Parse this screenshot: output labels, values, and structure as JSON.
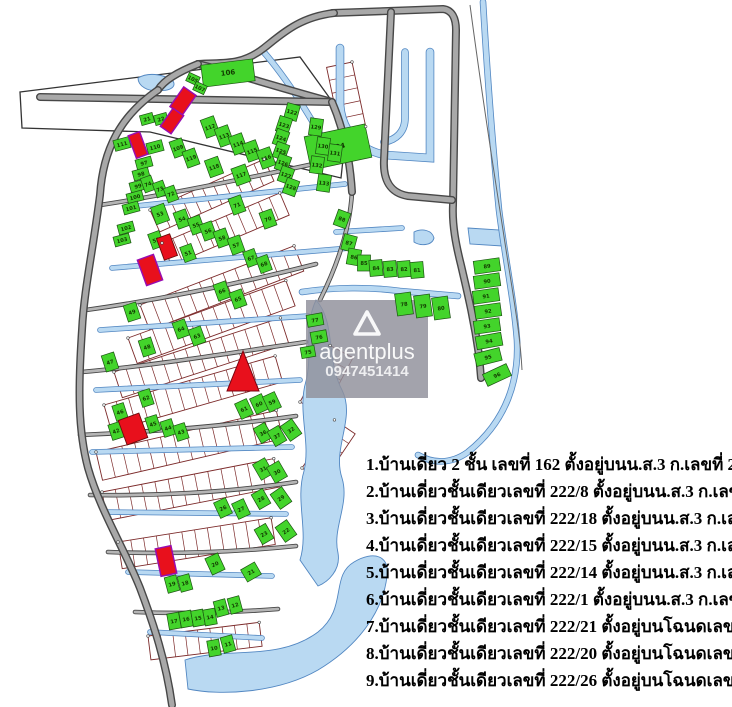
{
  "watermark": {
    "brand": "agentplus",
    "phone": "0947451414",
    "logo": "triangle-logo"
  },
  "listings": {
    "lines": [
      "1.บ้านเดี่ยว 2 ชั้น เลขที่ 162  ตั้งอยู่บนน.ส.3 ก.เลขที่ 2524",
      "2.บ้านเดี่ยวชั้นเดียวเลขที่ 222/8   ตั้งอยู่บนน.ส.3 ก.เลขที่ 2586",
      "3.บ้านเดี่ยวชั้นเดียวเลขที่ 222/18 ตั้งอยู่บนน.ส.3 ก.เลขที่ 2587",
      "4.บ้านเดี่ยวชั้นเดียวเลขที่ 222/15 ตั้งอยู่บนน.ส.3 ก.เลขที่ 2608",
      "5.บ้านเดี่ยวชั้นเดียวเลขที่ 222/14 ตั้งอยู่บนน.ส.3 ก.เลขที่ 2621",
      "6.บ้านเดี่ยวชั้นเดียวเลขที่ 222/1   ตั้งอยู่บนน.ส.3 ก.เลขที่ 2649",
      "7.บ้านเดี่ยวชั้นเดียวเลขที่ 222/21 ตั้งอยู่บนโฉนดเลขที่ 50090",
      "8.บ้านเดี่ยวชั้นเดียวเลขที่ 222/20 ตั้งอยู่บนโฉนดเลขที่ 50739",
      "9.บ้านเดี่ยวชั้นเดียวเลขที่ 222/26 ตั้งอยู่บนโฉนดเลขที่ 50749"
    ]
  },
  "colors": {
    "plot_green": "#43d42b",
    "plot_green_edge": "#1e6d12",
    "plot_red": "#e8101c",
    "plot_red_edge": "#6a0a0a",
    "plot_red_purple_edge": "#990cb0",
    "road_fill": "#a8a8a8",
    "road_edge": "#474747",
    "water_fill": "#b9d9f2",
    "water_edge": "#5287c2",
    "parcel_line": "#7c2a2a",
    "watermark_bg": "rgba(144,144,155,0.83)"
  },
  "map": {
    "runway": "20,92 300,57 347,122 341,178 150,132 22,128",
    "outline_paths": [
      "M 470,5 C 480,80 492,160 503,230 C 512,290 520,330 522,370"
    ],
    "parcel_rows": [
      {
        "x": 150,
        "y": 210,
        "len": 125,
        "depth": 24,
        "angle": -24,
        "count": 11
      },
      {
        "x": 162,
        "y": 243,
        "len": 128,
        "depth": 24,
        "angle": -23,
        "count": 11
      },
      {
        "x": 140,
        "y": 305,
        "len": 165,
        "depth": 27,
        "angle": -21,
        "count": 13
      },
      {
        "x": 128,
        "y": 338,
        "len": 168,
        "depth": 27,
        "angle": -20,
        "count": 13
      },
      {
        "x": 114,
        "y": 372,
        "len": 175,
        "depth": 27,
        "angle": -18,
        "count": 14
      },
      {
        "x": 104,
        "y": 405,
        "len": 178,
        "depth": 27,
        "angle": -16,
        "count": 14
      },
      {
        "x": 96,
        "y": 452,
        "len": 185,
        "depth": 29,
        "angle": -13,
        "count": 14
      },
      {
        "x": 102,
        "y": 492,
        "len": 175,
        "depth": 29,
        "angle": -11,
        "count": 13
      },
      {
        "x": 118,
        "y": 542,
        "len": 155,
        "depth": 27,
        "angle": -9,
        "count": 12
      },
      {
        "x": 148,
        "y": 636,
        "len": 112,
        "depth": 24,
        "angle": -7,
        "count": 9
      },
      {
        "x": 352,
        "y": 62,
        "len": 66,
        "depth": 26,
        "angle": 78,
        "count": 5
      },
      {
        "x": 300,
        "y": 402,
        "len": 64,
        "depth": 26,
        "angle": -62,
        "count": 5
      },
      {
        "x": 302,
        "y": 468,
        "len": 58,
        "depth": 25,
        "angle": -56,
        "count": 5
      }
    ],
    "water_bodies": [
      "M 316,300 C 336,322 326,360 342,390 C 356,418 332,448 342,478 C 350,504 332,528 338,553 C 341,570 328,582 318,586 L 300,560 C 309,531 295,501 304,471 C 311,441 297,411 306,381 C 313,354 303,328 316,300 Z",
      "M 185,660 C 228,646 278,662 318,632 C 348,608 330,576 354,562 C 374,550 390,556 387,576 C 383,612 358,646 318,670 C 278,693 220,696 188,689 Z",
      "M 468,228 L 500,230 L 502,246 L 470,244 Z",
      "M 414,232 C 422,228 432,230 434,238 C 432,246 420,246 414,242 Z",
      "M 138,78 C 148,72 162,74 172,80 C 178,86 170,92 158,90 C 148,92 138,86 138,78 Z"
    ],
    "canals": [
      {
        "d": "M 340,48 L 340,105 C 342,132 360,150 385,155 L 430,158 L 430,52",
        "w": 7
      },
      {
        "d": "M 405,52 L 405,118 C 405,132 396,140 384,142",
        "w": 6
      },
      {
        "d": "M 262,50 C 290,82 312,120 334,158",
        "w": 5
      },
      {
        "d": "M 483,2 C 487,70 492,140 499,210 C 505,258 514,300 517,340 C 519,378 508,420 468,452 C 450,465 432,463 418,455",
        "w": 5
      },
      {
        "d": "M 136,206 L 345,184",
        "w": 4
      },
      {
        "d": "M 112,268 L 350,248",
        "w": 4
      },
      {
        "d": "M 100,330 L 308,316",
        "w": 4
      },
      {
        "d": "M 96,390 L 300,380",
        "w": 4
      },
      {
        "d": "M 92,452 L 292,447",
        "w": 4
      },
      {
        "d": "M 104,512 L 286,514",
        "w": 4
      },
      {
        "d": "M 128,572 L 272,576",
        "w": 4
      },
      {
        "d": "M 150,632 L 262,638",
        "w": 4
      },
      {
        "d": "M 302,292 C 335,287 370,287 400,291 L 458,296",
        "w": 5
      },
      {
        "d": "M 336,232 L 402,228",
        "w": 4
      }
    ],
    "roads_major": [
      "M 332,13 L 443,9 C 452,10 456,18 456,30 L 453,205 C 452,225 456,245 461,265 C 468,295 474,320 479,355 L 481,378",
      "M 391,12 L 384,160 C 383,180 390,193 408,196 L 452,200",
      "M 334,13 C 300,17 283,33 264,48 C 240,67 220,62 198,64",
      "M 198,64 C 230,72 280,88 332,102",
      "M 40,97 L 332,102",
      "M 198,64 C 178,72 164,80 158,90",
      "M 158,90 C 120,116 103,150 100,195 C 93,250 84,290 82,330 C 78,390 78,430 88,468 C 100,510 124,548 140,588 C 154,625 166,662 172,705",
      "M 332,102 C 344,130 350,160 352,192"
    ],
    "roads_minor": [
      "M 100,205 C 160,196 240,180 332,160",
      "M 86,310 C 150,301 230,286 316,264",
      "M 82,372 C 150,366 230,353 306,342",
      "M 80,435 C 150,432 226,426 296,416",
      "M 90,495 C 150,496 226,493 296,482",
      "M 108,552 C 160,554 226,553 296,546",
      "M 135,612 C 180,614 226,613 278,609",
      "M 352,192 C 350,230 336,268 320,300"
    ],
    "plots_green": [
      [
        106,
        228,
        73,
        52,
        22,
        -7
      ],
      [
        105,
        193,
        79,
        12,
        9,
        25
      ],
      [
        107,
        200,
        88,
        12,
        9,
        25
      ],
      [
        104,
        338,
        147,
        62,
        34,
        -12
      ],
      [
        21,
        147,
        119,
        13,
        10,
        -15
      ],
      [
        22,
        161,
        119,
        13,
        10,
        -15
      ],
      [
        111,
        122,
        144,
        16,
        11,
        -15
      ],
      [
        110,
        155,
        147,
        16,
        11,
        -15
      ],
      [
        97,
        144,
        163,
        16,
        10,
        -15
      ],
      [
        98,
        141,
        174,
        16,
        10,
        -15
      ],
      [
        99,
        138,
        186,
        16,
        10,
        -15
      ],
      [
        100,
        135,
        197,
        16,
        10,
        -15
      ],
      [
        101,
        131,
        208,
        16,
        10,
        -15
      ],
      [
        102,
        126,
        228,
        16,
        10,
        -15
      ],
      [
        103,
        122,
        240,
        16,
        10,
        -15
      ],
      [
        109,
        178,
        148,
        13,
        17,
        -20
      ],
      [
        112,
        210,
        127,
        14,
        19,
        -20
      ],
      [
        113,
        224,
        136,
        14,
        19,
        -20
      ],
      [
        114,
        238,
        144,
        14,
        19,
        -20
      ],
      [
        115,
        252,
        151,
        14,
        19,
        -20
      ],
      [
        116,
        266,
        158,
        14,
        19,
        -20
      ],
      [
        119,
        191,
        158,
        13,
        17,
        -20
      ],
      [
        118,
        214,
        167,
        14,
        18,
        -20
      ],
      [
        117,
        241,
        175,
        15,
        18,
        -20
      ],
      [
        122,
        292,
        112,
        13,
        16,
        15
      ],
      [
        123,
        284,
        125,
        13,
        16,
        18
      ],
      [
        124,
        281,
        138,
        13,
        16,
        20
      ],
      [
        125,
        281,
        151,
        13,
        16,
        20
      ],
      [
        126,
        283,
        163,
        13,
        16,
        20
      ],
      [
        127,
        286,
        175,
        13,
        16,
        20
      ],
      [
        128,
        291,
        187,
        13,
        16,
        20
      ],
      [
        129,
        316,
        127,
        13,
        17,
        8
      ],
      [
        130,
        323,
        146,
        13,
        17,
        8
      ],
      [
        131,
        335,
        153,
        13,
        17,
        8
      ],
      [
        132,
        317,
        165,
        13,
        17,
        8
      ],
      [
        133,
        324,
        183,
        13,
        17,
        8
      ],
      [
        74,
        148,
        184,
        11,
        15,
        -20
      ],
      [
        73,
        160,
        189,
        11,
        15,
        -20
      ],
      [
        72,
        171,
        194,
        11,
        15,
        -20
      ],
      [
        71,
        237,
        205,
        13,
        17,
        -20
      ],
      [
        70,
        268,
        219,
        13,
        17,
        -20
      ],
      [
        53,
        160,
        214,
        14,
        18,
        -20
      ],
      [
        54,
        182,
        219,
        13,
        17,
        -20
      ],
      [
        55,
        196,
        225,
        13,
        17,
        -20
      ],
      [
        56,
        208,
        231,
        13,
        17,
        -20
      ],
      [
        58,
        222,
        238,
        13,
        17,
        -20
      ],
      [
        57,
        236,
        245,
        13,
        17,
        -20
      ],
      [
        52,
        156,
        240,
        12,
        16,
        -20
      ],
      [
        51,
        188,
        253,
        12,
        16,
        -20
      ],
      [
        67,
        251,
        258,
        12,
        16,
        -20
      ],
      [
        68,
        264,
        264,
        12,
        16,
        -20
      ],
      [
        66,
        222,
        291,
        13,
        17,
        -20
      ],
      [
        65,
        238,
        299,
        13,
        17,
        -20
      ],
      [
        64,
        181,
        329,
        13,
        17,
        -20
      ],
      [
        63,
        197,
        336,
        13,
        17,
        -20
      ],
      [
        49,
        132,
        312,
        13,
        17,
        -18
      ],
      [
        48,
        147,
        347,
        13,
        17,
        -18
      ],
      [
        47,
        110,
        362,
        13,
        17,
        -18
      ],
      [
        62,
        146,
        398,
        12,
        16,
        -18
      ],
      [
        46,
        120,
        412,
        12,
        16,
        -18
      ],
      [
        45,
        153,
        424,
        12,
        16,
        -18
      ],
      [
        44,
        168,
        428,
        12,
        16,
        -18
      ],
      [
        43,
        181,
        432,
        12,
        16,
        -18
      ],
      [
        42,
        116,
        431,
        12,
        16,
        -18
      ],
      [
        61,
        244,
        409,
        13,
        17,
        -25
      ],
      [
        60,
        259,
        404,
        13,
        17,
        -25
      ],
      [
        59,
        272,
        402,
        13,
        17,
        -25
      ],
      [
        36,
        263,
        433,
        13,
        17,
        -30
      ],
      [
        37,
        277,
        436,
        13,
        17,
        -30
      ],
      [
        32,
        291,
        430,
        14,
        18,
        -35
      ],
      [
        31,
        263,
        469,
        14,
        18,
        -30
      ],
      [
        30,
        277,
        472,
        14,
        18,
        -30
      ],
      [
        28,
        261,
        499,
        13,
        17,
        -30
      ],
      [
        29,
        281,
        498,
        14,
        18,
        -35
      ],
      [
        26,
        223,
        508,
        13,
        17,
        -25
      ],
      [
        27,
        241,
        509,
        13,
        17,
        -25
      ],
      [
        23,
        264,
        534,
        13,
        17,
        -30
      ],
      [
        22,
        286,
        531,
        14,
        18,
        -35
      ],
      [
        88,
        342,
        219,
        13,
        16,
        20
      ],
      [
        87,
        349,
        243,
        13,
        16,
        15
      ],
      [
        86,
        354,
        257,
        13,
        16,
        10
      ],
      [
        85,
        364,
        263,
        13,
        16,
        0
      ],
      [
        84,
        376,
        268,
        13,
        16,
        -5
      ],
      [
        83,
        390,
        269,
        13,
        16,
        -5
      ],
      [
        82,
        404,
        269,
        13,
        16,
        -5
      ],
      [
        81,
        417,
        270,
        13,
        16,
        -5
      ],
      [
        78,
        404,
        304,
        16,
        22,
        -8
      ],
      [
        79,
        423,
        306,
        16,
        22,
        -8
      ],
      [
        80,
        441,
        308,
        16,
        22,
        -8
      ],
      [
        77,
        315,
        320,
        16,
        12,
        -10
      ],
      [
        76,
        319,
        337,
        16,
        12,
        -10
      ],
      [
        75,
        308,
        352,
        14,
        11,
        -10
      ],
      [
        89,
        487,
        266,
        26,
        13,
        -8
      ],
      [
        90,
        487,
        281,
        26,
        13,
        -8
      ],
      [
        91,
        486,
        296,
        26,
        13,
        -8
      ],
      [
        92,
        488,
        311,
        26,
        13,
        -8
      ],
      [
        93,
        487,
        326,
        26,
        13,
        -8
      ],
      [
        94,
        489,
        341,
        26,
        13,
        -10
      ],
      [
        95,
        488,
        357,
        26,
        13,
        -14
      ],
      [
        96,
        497,
        375,
        26,
        13,
        -25
      ],
      [
        20,
        215,
        564,
        14,
        18,
        -25
      ],
      [
        21,
        251,
        572,
        16,
        14,
        -30
      ],
      [
        19,
        172,
        584,
        12,
        16,
        -15
      ],
      [
        18,
        185,
        583,
        12,
        16,
        -15
      ],
      [
        17,
        174,
        621,
        12,
        16,
        -10
      ],
      [
        16,
        186,
        619,
        12,
        16,
        -10
      ],
      [
        15,
        198,
        618,
        12,
        16,
        -10
      ],
      [
        14,
        210,
        617,
        12,
        16,
        -10
      ],
      [
        13,
        221,
        608,
        12,
        16,
        -15
      ],
      [
        12,
        235,
        605,
        12,
        16,
        -15
      ],
      [
        10,
        214,
        648,
        12,
        16,
        -10
      ],
      [
        11,
        228,
        644,
        12,
        16,
        -15
      ]
    ],
    "plots_red": [
      [
        183,
        101,
        15,
        24,
        35,
        true
      ],
      [
        172,
        121,
        13,
        22,
        35,
        true
      ],
      [
        138,
        145,
        12,
        24,
        -20,
        true
      ],
      [
        167,
        247,
        14,
        23,
        -20,
        false
      ],
      [
        150,
        270,
        17,
        27,
        -20,
        true
      ],
      [
        133,
        429,
        22,
        26,
        -20,
        false
      ],
      [
        166,
        561,
        16,
        28,
        -12,
        true
      ]
    ],
    "triangle_marker": "243,351 227,391 259,391",
    "watermark_box": {
      "x": 306,
      "y": 300,
      "w": 122,
      "h": 98
    }
  }
}
